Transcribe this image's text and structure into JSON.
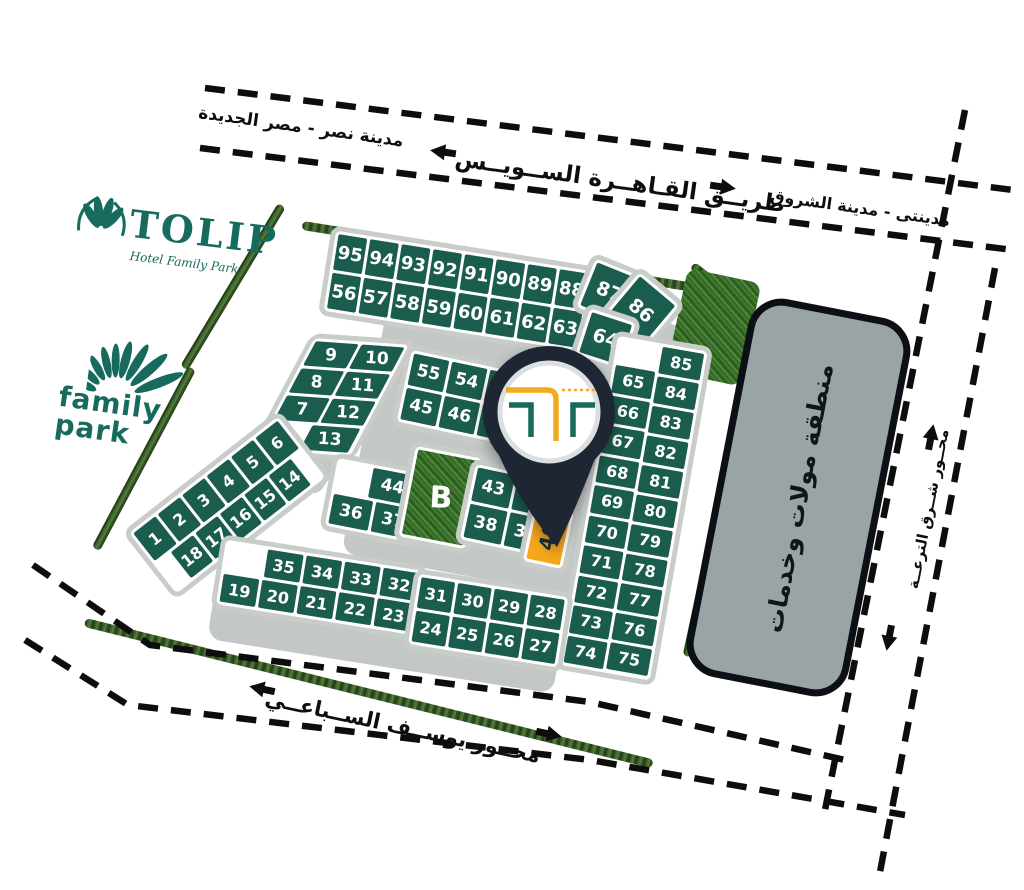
{
  "roads": {
    "cairo_suez": {
      "name": "طريــق القـاهــرة الســويــس",
      "west_label": "مدينة نصر - مصر الجديدة",
      "east_label": "مدينتى - مدينة الشروق"
    },
    "youssef_sebaei": {
      "name": "محــور يوســف الســباعــي"
    },
    "east_axis": {
      "name": "محــور شــرق الترعــة"
    }
  },
  "zones": {
    "mall": "منطقة مولات وخدمات"
  },
  "logos": {
    "tolip_title": "TOLIP",
    "tolip_subtitle": "Hotel Family Park",
    "family_line1": "family",
    "family_line2": "park"
  },
  "pin": {
    "target_plot": "40"
  },
  "blocks": {
    "top_band": [
      [
        "95",
        "94",
        "93",
        "92",
        "91",
        "90",
        "89",
        "88"
      ],
      [
        "56",
        "57",
        "58",
        "59",
        "60",
        "61",
        "62",
        "63"
      ]
    ],
    "fan": [
      "87",
      "86",
      "64"
    ],
    "right_band_inner": [
      "65",
      "66",
      "67",
      "68",
      "69",
      "70",
      "71",
      "72",
      "73",
      "74"
    ],
    "right_band_outer": [
      "85",
      "84",
      "83",
      "82",
      "81",
      "80",
      "79",
      "78",
      "77",
      "76",
      "75"
    ],
    "left_cluster": [
      [
        "9",
        "10"
      ],
      [
        "8",
        "11"
      ],
      [
        "7",
        "12"
      ],
      [
        "13"
      ]
    ],
    "left_band": [
      [
        "1",
        "2",
        "3",
        "4",
        "5",
        "6"
      ],
      [
        "18",
        "17",
        "16",
        "15",
        "14"
      ]
    ],
    "mid_small": [
      [
        "44"
      ],
      [
        "36",
        "37"
      ]
    ],
    "b": [
      "B"
    ],
    "mid_upper": [
      [
        "55",
        "54",
        ""
      ],
      [
        "45",
        "46",
        "47"
      ]
    ],
    "mid_lower": [
      [
        "43",
        "42"
      ],
      [
        "38",
        "39"
      ]
    ],
    "highlight": [
      "40"
    ],
    "bottom_left": [
      [
        "35",
        "34",
        "33",
        "32"
      ],
      [
        "19",
        "20",
        "21",
        "22",
        "23"
      ]
    ],
    "bottom_mid": [
      [
        "31",
        "30",
        "29",
        "28"
      ],
      [
        "24",
        "25",
        "26",
        "27"
      ]
    ]
  },
  "colors": {
    "plot_green": "#1a5c4e",
    "block_border": "#c9cdca",
    "road_gray": "#c3c8c6",
    "highlight_gold": "#f6a71b",
    "pin_dark": "#1e2633",
    "pin_ring": "#dcdfe1",
    "logo_teal": "#176a5e",
    "logo_gold": "#f0ac1f",
    "mall_gray": "#9aa3a6",
    "mall_border": "#0c0f14",
    "line_black": "#0d0d0d"
  }
}
